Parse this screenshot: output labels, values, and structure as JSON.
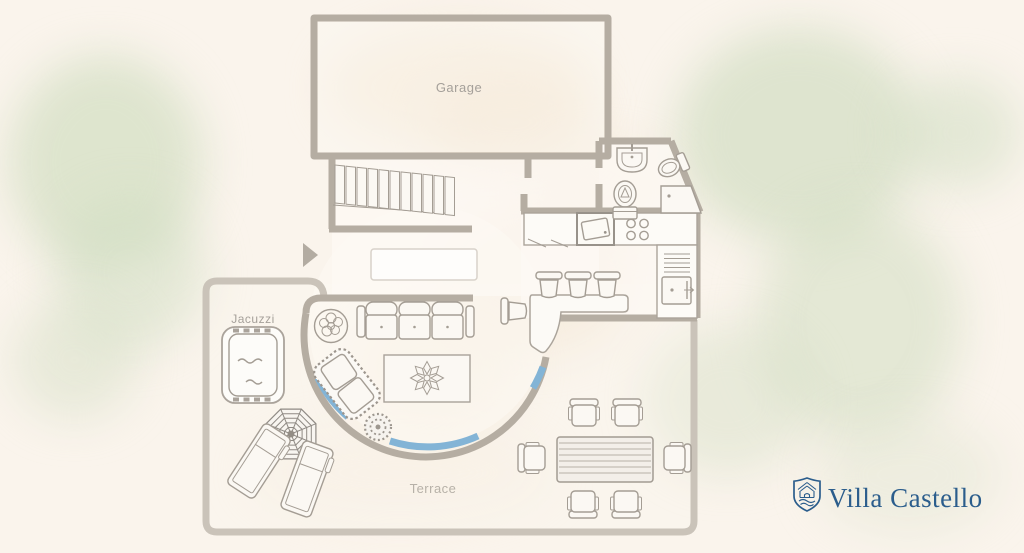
{
  "brand": {
    "name": "Villa Castello",
    "color": "#2b5d8c",
    "icon": "shield-crest-icon"
  },
  "labels": {
    "garage": "Garage",
    "jacuzzi": "Jacuzzi",
    "terrace": "Terrace"
  },
  "colors": {
    "background": "#faf4ec",
    "wall": "#b5ada2",
    "terrace_wall": "#cac3b9",
    "glass": "#83b4d6",
    "furniture_line": "#a49d94",
    "floor": "#fcf9f4",
    "label_text": "#a5a09a",
    "label_text_light": "#b7b1a8",
    "watercolor_green": "#cdd9c0",
    "watercolor_peach": "#f0dfc6"
  },
  "areas": {
    "labeled": [
      "garage",
      "jacuzzi",
      "terrace"
    ],
    "unlabeled": [
      "hallway",
      "stairs",
      "living-area",
      "kitchen",
      "bathroom"
    ]
  },
  "furniture": [
    {
      "name": "staircase-steps",
      "count": 11
    },
    {
      "name": "entrance-arrow",
      "count": 1
    },
    {
      "name": "sideboard",
      "count": 1
    },
    {
      "name": "sofa",
      "count": 1
    },
    {
      "name": "potted-plant",
      "count": 2
    },
    {
      "name": "chaise-lounge",
      "count": 1
    },
    {
      "name": "coffee-table",
      "count": 1
    },
    {
      "name": "jacuzzi-tub",
      "count": 1
    },
    {
      "name": "parasol",
      "count": 1
    },
    {
      "name": "sun-lounger",
      "count": 2
    },
    {
      "name": "bar-counter",
      "count": 1
    },
    {
      "name": "bar-stool",
      "count": 4
    },
    {
      "name": "kitchen-sink",
      "count": 1
    },
    {
      "name": "cooktop-burner",
      "count": 4
    },
    {
      "name": "oven",
      "count": 1
    },
    {
      "name": "washbasin",
      "count": 1
    },
    {
      "name": "toilet",
      "count": 1
    },
    {
      "name": "bidet",
      "count": 1
    },
    {
      "name": "shower",
      "count": 1
    },
    {
      "name": "dining-table",
      "count": 1
    },
    {
      "name": "dining-chair",
      "count": 6
    }
  ]
}
